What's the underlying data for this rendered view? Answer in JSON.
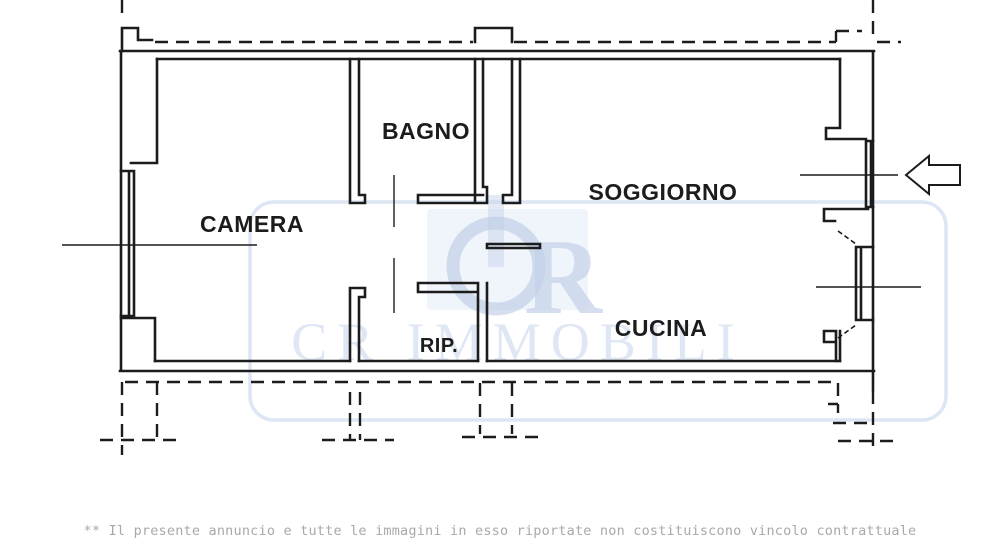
{
  "plan": {
    "type": "apartment-floor-plan",
    "rooms": [
      {
        "id": "camera",
        "label": "CAMERA"
      },
      {
        "id": "bagno",
        "label": "BAGNO"
      },
      {
        "id": "soggiorno",
        "label": "SOGGIORNO"
      },
      {
        "id": "cucina",
        "label": "CUCINA"
      },
      {
        "id": "rip",
        "label": "RIP."
      }
    ],
    "entrance_arrow": "left-pointing block arrow at right side"
  },
  "watermark": {
    "logo_letter": "R",
    "brand": "CR IMMOBILI"
  },
  "footer": {
    "disclaimer": "** Il presente annuncio e tutte le immagini in esso riportate non costituiscono vincolo contrattuale"
  },
  "colors": {
    "background": "#ffffff",
    "wall": "#1c1c1c",
    "watermark_line": "#dde6f4",
    "watermark_text": "#c3d1e9",
    "disclaimer_text": "#a9a9a9"
  }
}
